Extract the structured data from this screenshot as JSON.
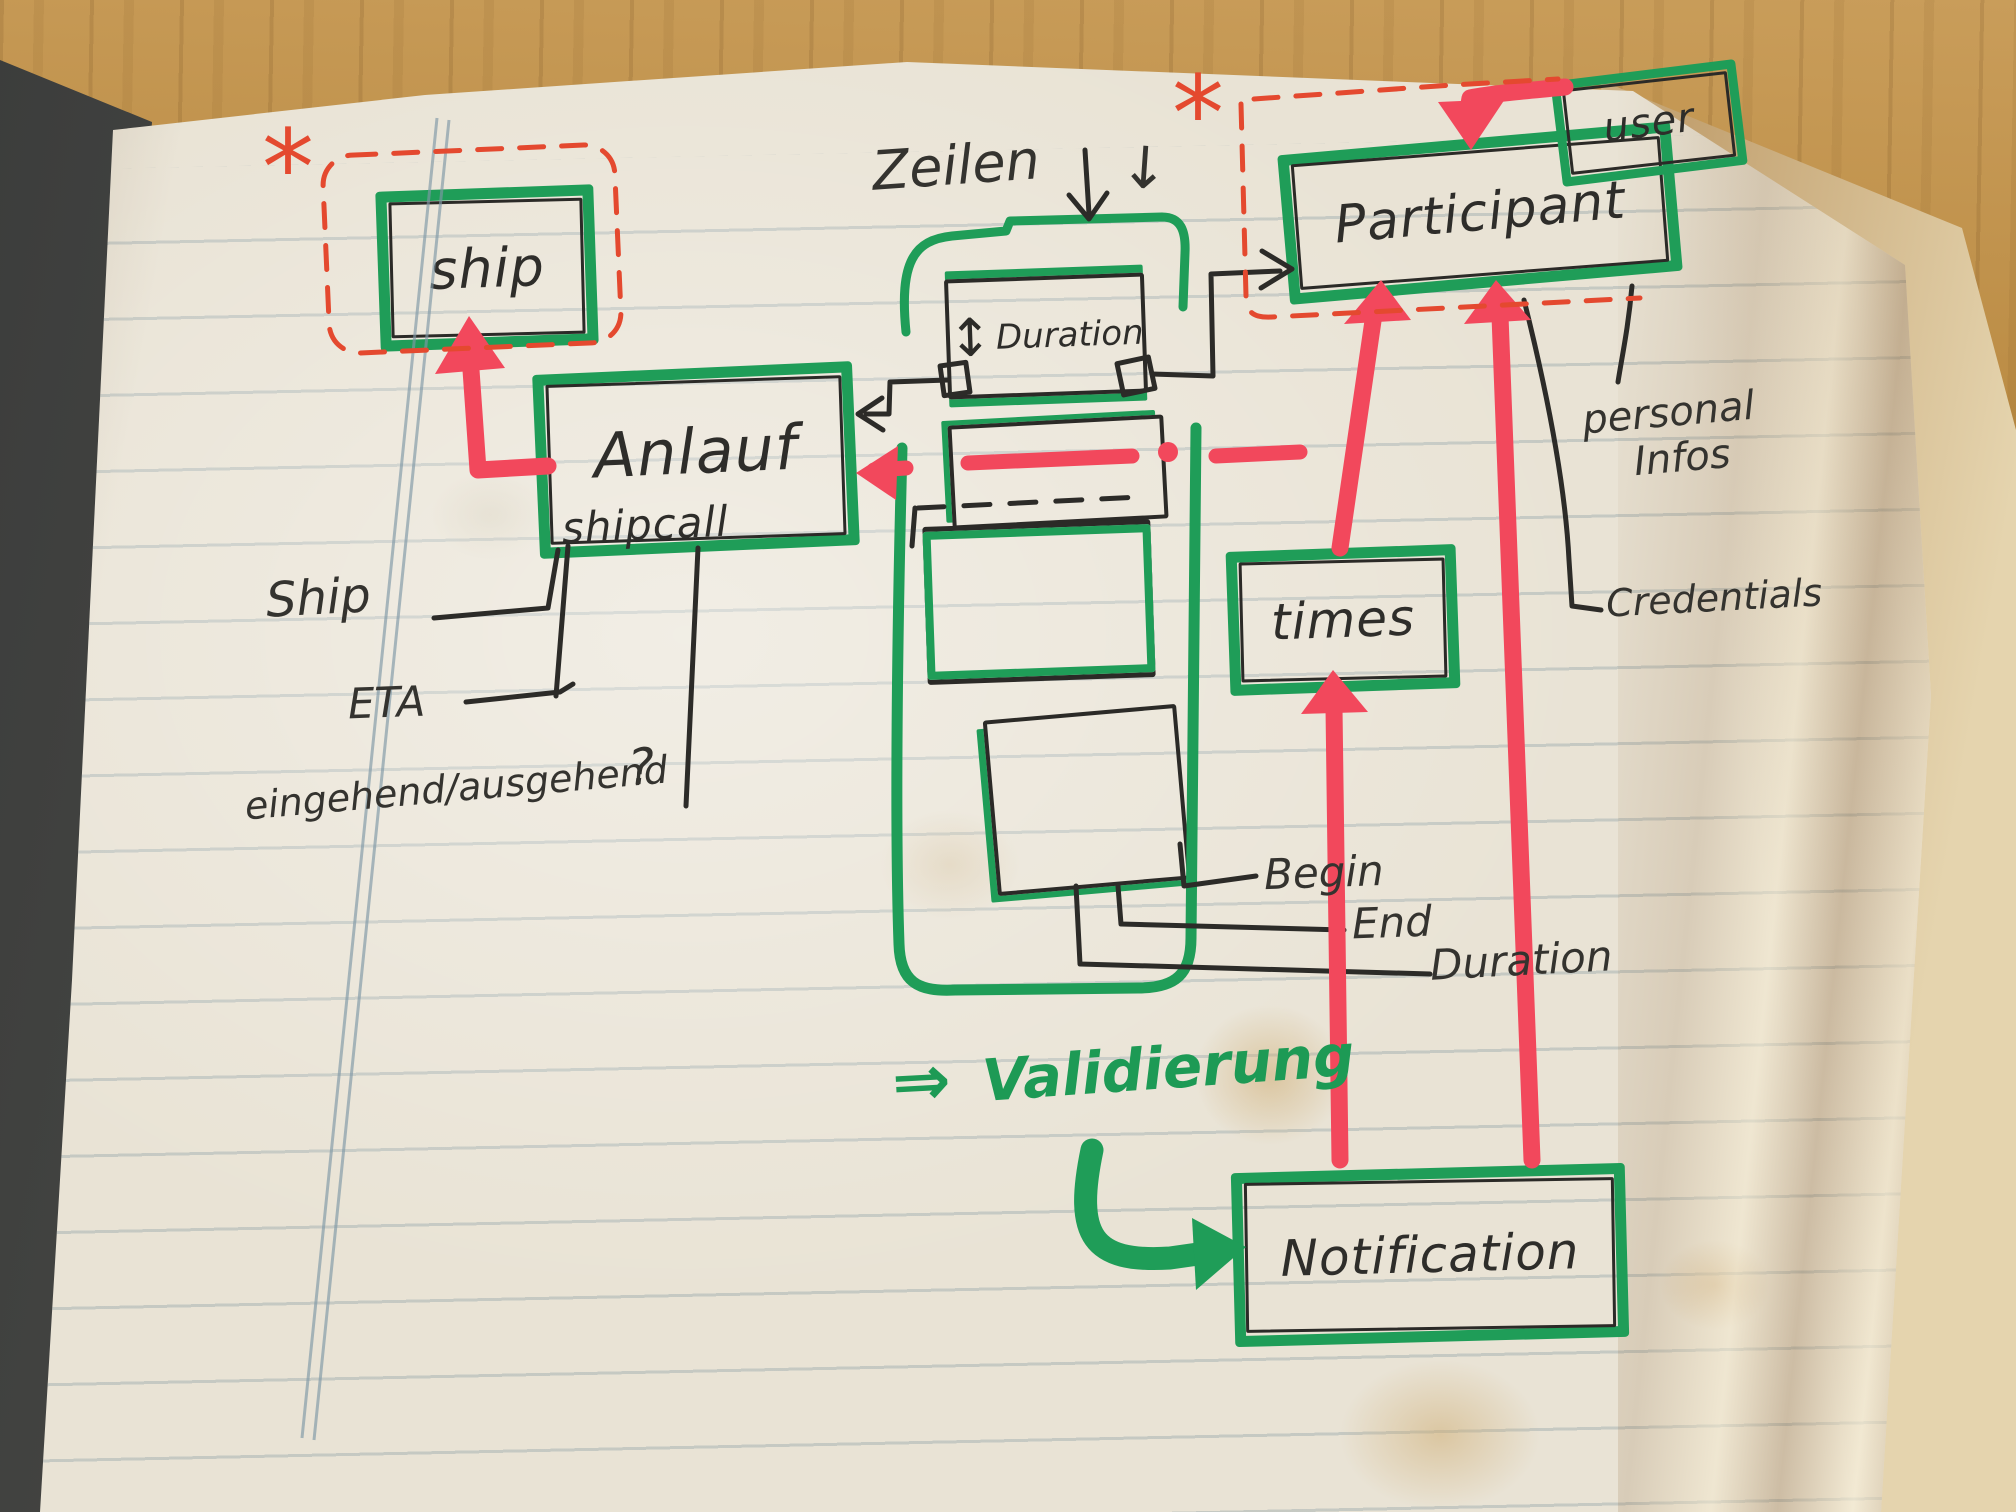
{
  "scene": {
    "description": "Hand-drawn entity diagram sketched in a paper notebook lying on a wooden desk",
    "colors": {
      "marker_green": "#1f9d58",
      "marker_red": "#f2485c",
      "pen_red": "#e4492f",
      "pen_black": "#2c2b28",
      "paper": "#e9e3d5"
    }
  },
  "boxes": {
    "ship": "ship",
    "shipcall_title": "Anlauf",
    "shipcall_subtitle": "shipcall",
    "duration": "Duration",
    "duration_arrow": "↕",
    "participant": "Participant",
    "user": "user",
    "times": "times",
    "notification": "Notification"
  },
  "labels": {
    "zeilen": "Zeilen",
    "zeilen_arrow": "↓",
    "asterisk_left": "*",
    "asterisk_right": "*",
    "ship_attr": "Ship",
    "eta_attr": "ETA",
    "in_out_attr": "eingehend/ausgehend",
    "question": "?",
    "begin_attr": "Begin",
    "end_attr": "End",
    "duration_attr": "Duration",
    "personal_attr_line1": "personal",
    "personal_attr_line2": "Infos",
    "credentials_attr": "Credentials",
    "validierung_arrow": "⇒",
    "validierung": "Validierung"
  },
  "edges": [
    {
      "from": "shipcall",
      "to": "ship",
      "style": "red-arrow"
    },
    {
      "from": "user",
      "to": "participant",
      "style": "red-arrow"
    },
    {
      "from": "times",
      "to": "participant",
      "style": "red-arrow"
    },
    {
      "from": "notification",
      "to": "times",
      "style": "red-arrow"
    },
    {
      "from": "notification",
      "to": "participant",
      "style": "red-arrow"
    },
    {
      "from": "times",
      "to": "shipcall",
      "style": "red-dashed-arrow"
    },
    {
      "from": "duration",
      "to": "shipcall",
      "style": "black-arrow"
    },
    {
      "from": "duration",
      "to": "participant",
      "style": "black-arrow"
    },
    {
      "from": "validierung",
      "to": "notification",
      "style": "green-curved-arrow"
    }
  ]
}
